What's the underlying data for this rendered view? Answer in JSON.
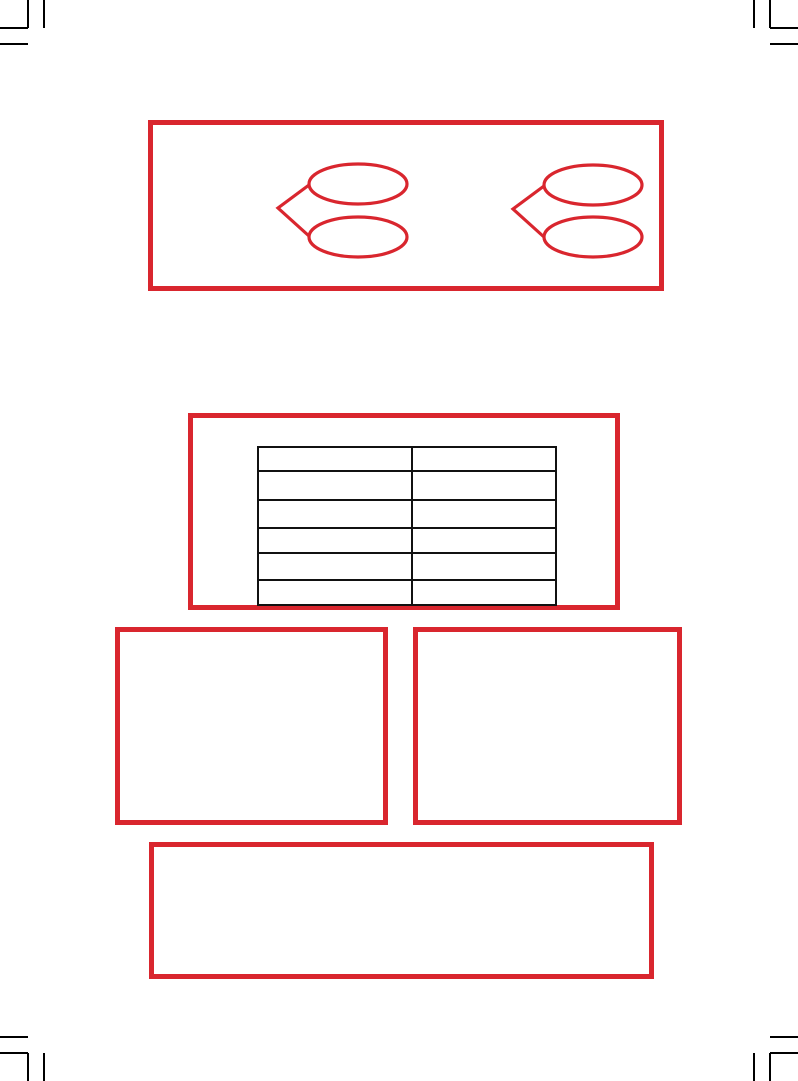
{
  "page": {
    "title": "",
    "visible_text": "",
    "description": "blank printable worksheet page with crop marks and red outline frames"
  },
  "colors": {
    "accent_red": "#d9262e",
    "line_black": "#111111",
    "mark_black": "#000000",
    "page_background": "#ffffff"
  },
  "crop_marks": {
    "corners": [
      "top-left",
      "top-right",
      "bottom-left",
      "bottom-right"
    ],
    "lines_per_corner": 4
  },
  "top_panel": {
    "shapes": [
      {
        "name": "double-bubble-branch-left",
        "bubbles": 2,
        "bubble_text": [
          "",
          ""
        ]
      },
      {
        "name": "double-bubble-branch-right",
        "bubbles": 2,
        "bubble_text": [
          "",
          ""
        ]
      }
    ]
  },
  "middle_panel": {
    "table": {
      "columns": 2,
      "rows": 6,
      "headers": [
        "",
        ""
      ],
      "cells": [
        [
          "",
          ""
        ],
        [
          "",
          ""
        ],
        [
          "",
          ""
        ],
        [
          "",
          ""
        ],
        [
          "",
          ""
        ],
        [
          "",
          ""
        ]
      ]
    }
  },
  "left_panel": {
    "content": ""
  },
  "right_panel": {
    "content": ""
  },
  "bottom_panel": {
    "content": ""
  }
}
